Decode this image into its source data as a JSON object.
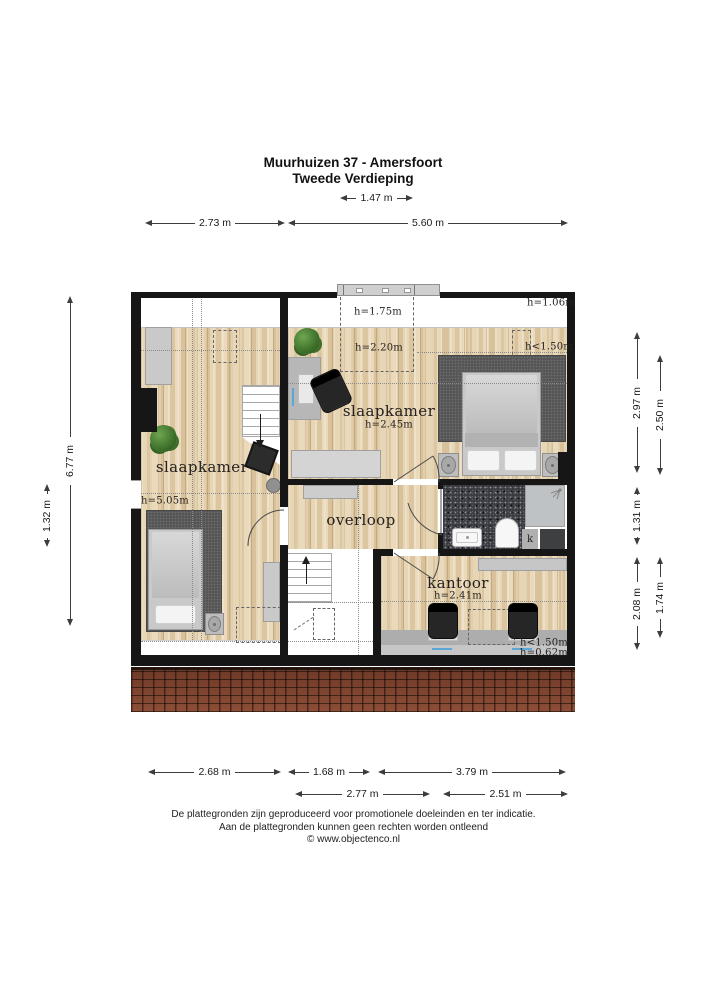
{
  "header": {
    "title": "Muurhuizen 37 - Amersfoort",
    "subtitle": "Tweede Verdieping"
  },
  "dims": {
    "w147": "1.47 m",
    "w273": "2.73 m",
    "w560": "5.60 m",
    "h677": "6.77 m",
    "h132": "1.32 m",
    "h297": "2.97 m",
    "h250": "2.50 m",
    "h131": "1.31 m",
    "h208": "2.08 m",
    "h174": "1.74 m",
    "w268": "2.68 m",
    "w168": "1.68 m",
    "w379": "3.79 m",
    "w277": "2.77 m",
    "w251": "2.51 m"
  },
  "rooms": {
    "bedroom_left": {
      "label": "slaapkamer",
      "height": "h=5.05m"
    },
    "bedroom_right": {
      "label": "slaapkamer",
      "height": "h=2.45m"
    },
    "landing": {
      "label": "overloop"
    },
    "office": {
      "label": "kantoor",
      "height": "h=2.41m"
    }
  },
  "annotations": {
    "dormer": "h=1.75m",
    "mid_ceiling": "h=2.20m",
    "top_right": "h=1.06m",
    "bedroom_low": "h<1.50m",
    "office_low": "h<1.50m",
    "office_lowest": "h=0.62m",
    "closet": "k"
  },
  "footer": {
    "line1": "De plattegronden zijn geproduceerd voor promotionele doeleinden en ter indicatie.",
    "line2": "Aan de plattegronden kunnen geen rechten worden ontleend",
    "line3": "© www.objectenco.nl"
  },
  "colors": {
    "wall": "#161616",
    "wood": "#e3cfae",
    "rug": "#565656",
    "bath": "#393b40",
    "roof": "#7a412f"
  }
}
